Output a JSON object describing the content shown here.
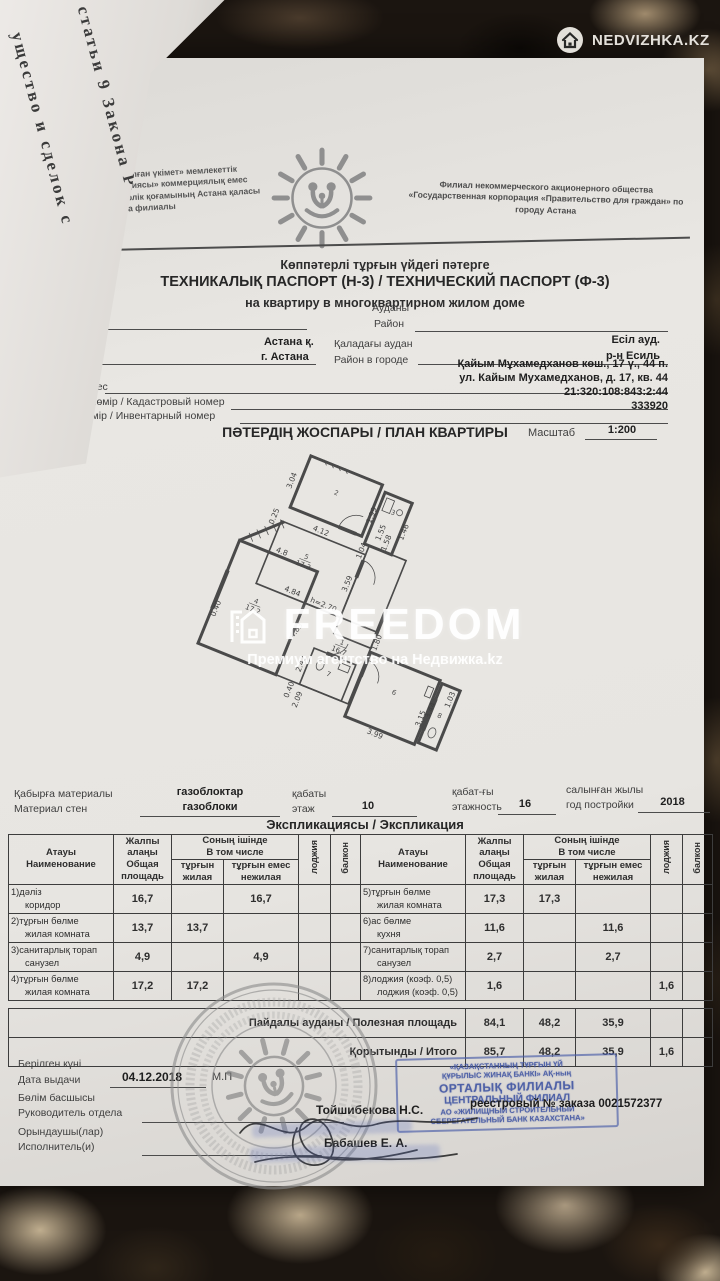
{
  "photo": {
    "brand": "NEDVIZHKA.KZ",
    "freedom_word": "FREEDOM",
    "freedom_tagline": "Премиум агентство на Недвижка.kz",
    "side_page_line1": "статьи 9 Закона Р",
    "side_page_line2": "ущество и сделок с"
  },
  "header": {
    "org_left": "арға арналған үкімет» мемлекеттік корпорациясы» коммерциялық емес акционерлік қоғамының Астана қаласы бойынша филиалы",
    "org_right": "Филиал некоммерческого акционерного общества «Государственная корпорация «Правительство для граждан» по городу Астана",
    "subtitle_kk": "Көппәтерлі тұрғын үйдегі пәтерге",
    "title": "ТЕХНИКАЛЫҚ ПАСПОРТ (Н-3) / ТЕХНИЧЕСКИЙ ПАСПОРТ (Ф-3)",
    "subtitle_ru": "на квартиру в многоквартирном жилом доме"
  },
  "fields": {
    "region_kk": "Облысы",
    "region_ru": "Область",
    "district_kk": "Ауданы",
    "district_ru": "Район",
    "city_kk": "Қала",
    "city_ru": "Город",
    "city_value_kk": "Астана қ.",
    "city_value_ru": "г. Астана",
    "city_district_kk": "Қаладағы аудан",
    "city_district_ru": "Район в городе",
    "city_district_value_kk": "Есіл ауд.",
    "city_district_value_ru": "р-н Есиль",
    "address_label": "Мекен-жайы Адрес",
    "address_value_kk": "Қайым Мұхамедханов көш., 17 ү., 44 п.",
    "address_value_ru": "ул. Кайым Мухамедханов, д. 17, кв. 44",
    "cadastre_label": "Кадастрлық нөмір / Кадастровый номер",
    "cadastre_value": "21:320:108:843:2:44",
    "inventory_label": "Түгендеу нөмір / Инвентарный номер",
    "inventory_value": "333920"
  },
  "plan": {
    "title": "ПӘТЕРДІҢ ЖОСПАРЫ / ПЛАН КВАРТИРЫ",
    "scale_label": "Масштаб",
    "scale_value": "1:200",
    "dimensions": [
      {
        "t": "3.04",
        "x": 42,
        "y": 42,
        "r": -90
      },
      {
        "t": "4.12",
        "x": 100,
        "y": 93,
        "r": 0
      },
      {
        "t": "0.25",
        "x": 38,
        "y": 95,
        "r": -90
      },
      {
        "t": "1.99",
        "x": 158,
        "y": 45,
        "r": -90
      },
      {
        "t": "1.46",
        "x": 206,
        "y": 50,
        "r": -90
      },
      {
        "t": "1.55",
        "x": 178,
        "y": 62,
        "r": -90
      },
      {
        "t": "1.58",
        "x": 190,
        "y": 72,
        "r": -90
      },
      {
        "t": "1.04",
        "x": 163,
        "y": 94,
        "r": -90
      },
      {
        "t": "4.84",
        "x": 95,
        "y": 182,
        "r": 0
      },
      {
        "t": "h=2.70",
        "x": 140,
        "y": 183,
        "r": 0
      },
      {
        "t": "3.59",
        "x": 162,
        "y": 142,
        "r": -90
      },
      {
        "t": "4.83",
        "x": 122,
        "y": 226,
        "r": -75
      },
      {
        "t": "1.80",
        "x": 228,
        "y": 200,
        "r": -90
      },
      {
        "t": "4.8",
        "x": 62,
        "y": 138,
        "r": 0
      },
      {
        "t": "0.40",
        "x": 12,
        "y": 238,
        "r": -90
      },
      {
        "t": "2.42",
        "x": 145,
        "y": 264,
        "r": -90
      },
      {
        "t": "0.40",
        "x": 143,
        "y": 302,
        "r": -90
      },
      {
        "t": "2.09",
        "x": 158,
        "y": 310,
        "r": -90
      },
      {
        "t": "3.99",
        "x": 268,
        "y": 317,
        "r": 0
      },
      {
        "t": "3.44",
        "x": 328,
        "y": 257,
        "r": -90
      },
      {
        "t": "1.03",
        "x": 347,
        "y": 234,
        "r": -90
      },
      {
        "t": "3.15",
        "x": 320,
        "y": 272,
        "r": -90
      }
    ],
    "rooms": [
      {
        "n": "2",
        "a": "",
        "x": 100,
        "y": 38
      },
      {
        "n": "3",
        "a": "",
        "x": 180,
        "y": 34
      },
      {
        "n": "5",
        "a": "17.3",
        "x": 95,
        "y": 132
      },
      {
        "n": "4",
        "a": "17.2",
        "x": 55,
        "y": 212
      },
      {
        "n": "1",
        "a": "16.7",
        "x": 182,
        "y": 220
      },
      {
        "n": "7",
        "a": "",
        "x": 181,
        "y": 266
      },
      {
        "n": "6",
        "a": "",
        "x": 271,
        "y": 256
      },
      {
        "n": "8",
        "a": "",
        "x": 339,
        "y": 262
      }
    ]
  },
  "building": {
    "walls_label_kk": "Қабырға материалы",
    "walls_label_ru": "Материал стен",
    "walls_value_kk": "газоблоктар",
    "walls_value_ru": "газоблоки",
    "floor_label_kk": "қабаты",
    "floor_label_ru": "этаж",
    "floor_value": "10",
    "floors_label_kk": "қабат-ғы",
    "floors_label_ru": "этажность",
    "floors_value": "16",
    "year_label_kk": "салынған жылы",
    "year_label_ru": "год постройки",
    "year_value": "2018"
  },
  "explication": {
    "title": "Экспликациясы / Экспликация",
    "head": {
      "name_kk": "Атауы",
      "name_ru": "Наименование",
      "total_kk": "Жалпы алаңы",
      "total_ru": "Общая площадь",
      "incl_kk": "Соның ішінде",
      "incl_ru": "В том числе",
      "living_kk": "тұрғын",
      "living_ru": "жилая",
      "nonliving_kk": "тұрғын емес",
      "nonliving_ru": "нежилая",
      "loggia": "лоджия",
      "balcony": "балкон"
    },
    "left_rows": [
      {
        "kk": "1)дәліз",
        "ru": "коридор",
        "total": "16,7",
        "living": "",
        "nonliving": "16,7",
        "loggia": "",
        "balcony": ""
      },
      {
        "kk": "2)тұрғын бөлме",
        "ru": "жилая комната",
        "total": "13,7",
        "living": "13,7",
        "nonliving": "",
        "loggia": "",
        "balcony": ""
      },
      {
        "kk": "3)санитарлық торап",
        "ru": "санузел",
        "total": "4,9",
        "living": "",
        "nonliving": "4,9",
        "loggia": "",
        "balcony": ""
      },
      {
        "kk": "4)тұрғын бөлме",
        "ru": "жилая комната",
        "total": "17,2",
        "living": "17,2",
        "nonliving": "",
        "loggia": "",
        "balcony": ""
      }
    ],
    "right_rows": [
      {
        "kk": "5)тұрғын бөлме",
        "ru": "жилая комната",
        "total": "17,3",
        "living": "17,3",
        "nonliving": "",
        "loggia": "",
        "balcony": ""
      },
      {
        "kk": "6)ас бөлме",
        "ru": "кухня",
        "total": "11,6",
        "living": "",
        "nonliving": "11,6",
        "loggia": "",
        "balcony": ""
      },
      {
        "kk": "7)санитарлық торап",
        "ru": "санузел",
        "total": "2,7",
        "living": "",
        "nonliving": "2,7",
        "loggia": "",
        "balcony": ""
      },
      {
        "kk": "8)лоджия (коэф. 0,5)",
        "ru": "лоджия (коэф. 0,5)",
        "total": "1,6",
        "living": "",
        "nonliving": "",
        "loggia": "1,6",
        "balcony": ""
      }
    ],
    "totals": [
      {
        "label": "Пайдалы ауданы / Полезная площадь",
        "total": "84,1",
        "living": "48,2",
        "nonliving": "35,9",
        "loggia": "",
        "balcony": ""
      },
      {
        "label": "Қорытынды / Итого",
        "total": "85,7",
        "living": "48,2",
        "nonliving": "35,9",
        "loggia": "1,6",
        "balcony": ""
      }
    ]
  },
  "footer": {
    "issue_date_kk": "Берілген күні",
    "issue_date_ru": "Дата выдачи",
    "issue_date_value": "04.12.2018",
    "mp": "М.П",
    "head_kk": "Бөлім басшысы",
    "head_ru": "Руководитель отдела",
    "head_name": "Тойшибекова Н.С.",
    "executor_kk": "Орындаушы(лар)",
    "executor_ru": "Исполнитель(и)",
    "executor_name": "Бабашев Е. А.",
    "order": "реестровый № заказа 0021572377",
    "bank": {
      "l1": "«ҚАЗАҚСТАННЫҢ ТҰРҒЫН ҮЙ",
      "l2": "ҚҰРЫЛЫС ЖИНАҚ БАНКІ» АҚ-ның",
      "l3": "ОРТАЛЫҚ ФИЛИАЛЫ",
      "l4": "ЦЕНТРАЛЬНЫЙ ФИЛИАЛ",
      "l5": "АО «ЖИЛИЩНЫЙ СТРОИТЕЛЬНЫЙ",
      "l6": "СБЕРЕГАТЕЛЬНЫЙ БАНК КАЗАХСТАНА»"
    }
  },
  "colors": {
    "stamp_blue": "#4a5ca8",
    "stamp_gray": "#8d8d8d",
    "paper": "#e7e5e1",
    "ink": "#3a3a3a"
  }
}
